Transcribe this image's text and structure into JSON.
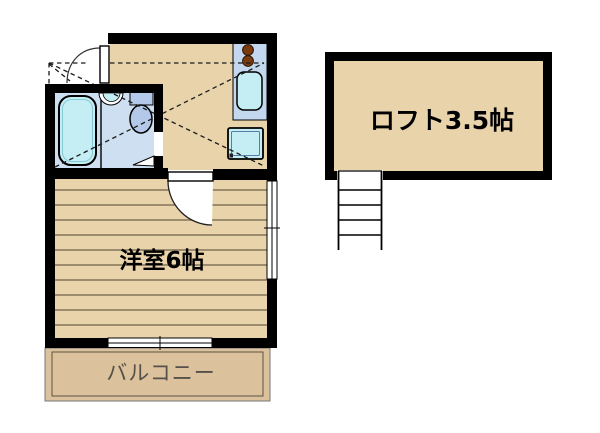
{
  "plan": {
    "title": "apartment-floor-plan",
    "rooms": {
      "loft": {
        "label": "ロフト3.5帖",
        "size_tatami": "3.5"
      },
      "western_room": {
        "label": "洋室6帖",
        "size_tatami": "6"
      },
      "balcony": {
        "label": "バルコニー"
      }
    },
    "fixtures": {
      "bathtub": "bathtub",
      "wash_basin": "wash-basin",
      "toilet": "toilet",
      "kitchen_counter": "kitchen-counter",
      "stove": "two-burner-stove",
      "kitchen_sink": "kitchen-sink",
      "washing_machine": "washing-machine-space",
      "entrance_door": "entrance-door",
      "room_door": "room-door",
      "bathroom_door": "bathroom-folding-door",
      "loft_ladder": "loft-ladder",
      "windows": "sliding-windows"
    },
    "colors": {
      "wall": "#000000",
      "floor": "#e9d3ab",
      "balcony_floor": "#dcc29c",
      "floor_stripe": "#6e6048",
      "counter": "#c3d8ef",
      "bath_floor": "#cedff2",
      "fixture": "#c5edf4",
      "toilet": "#b4c8e9",
      "burner": "#7b3a0e",
      "balcony_text": "#55514a",
      "white": "#ffffff"
    }
  }
}
